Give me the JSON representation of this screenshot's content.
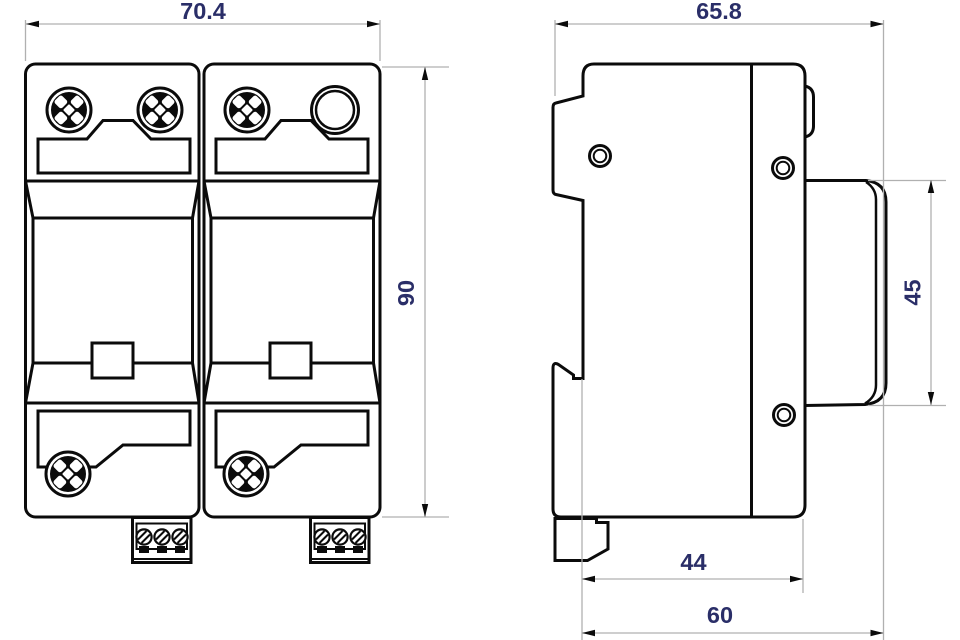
{
  "drawing": {
    "type": "technical-dimension-drawing",
    "subject": "2-module DIN-rail surge protection device, front and side orthographic views",
    "units_shown": false,
    "colors": {
      "line": "#0b0b0b",
      "dim_text": "#2a2e68",
      "dim_line": "#b0b0b0",
      "background": "#ffffff"
    },
    "views": [
      {
        "id": "front",
        "name": "front-view",
        "dimension_labels": [
          "70.4",
          "90"
        ]
      },
      {
        "id": "side",
        "name": "side-view",
        "dimension_labels": [
          "65.8",
          "45",
          "44",
          "60"
        ]
      }
    ],
    "dim_labels": {
      "front_width": "70.4",
      "front_height": "90",
      "side_total_width": "65.8",
      "side_pod_height": "45",
      "side_depth_inner": "44",
      "side_depth_outer": "60"
    },
    "icons": [
      "screw-head-icon",
      "indicator-window-icon",
      "terminal-screw-icon",
      "mounting-hole-icon",
      "arrowhead-icon"
    ]
  }
}
